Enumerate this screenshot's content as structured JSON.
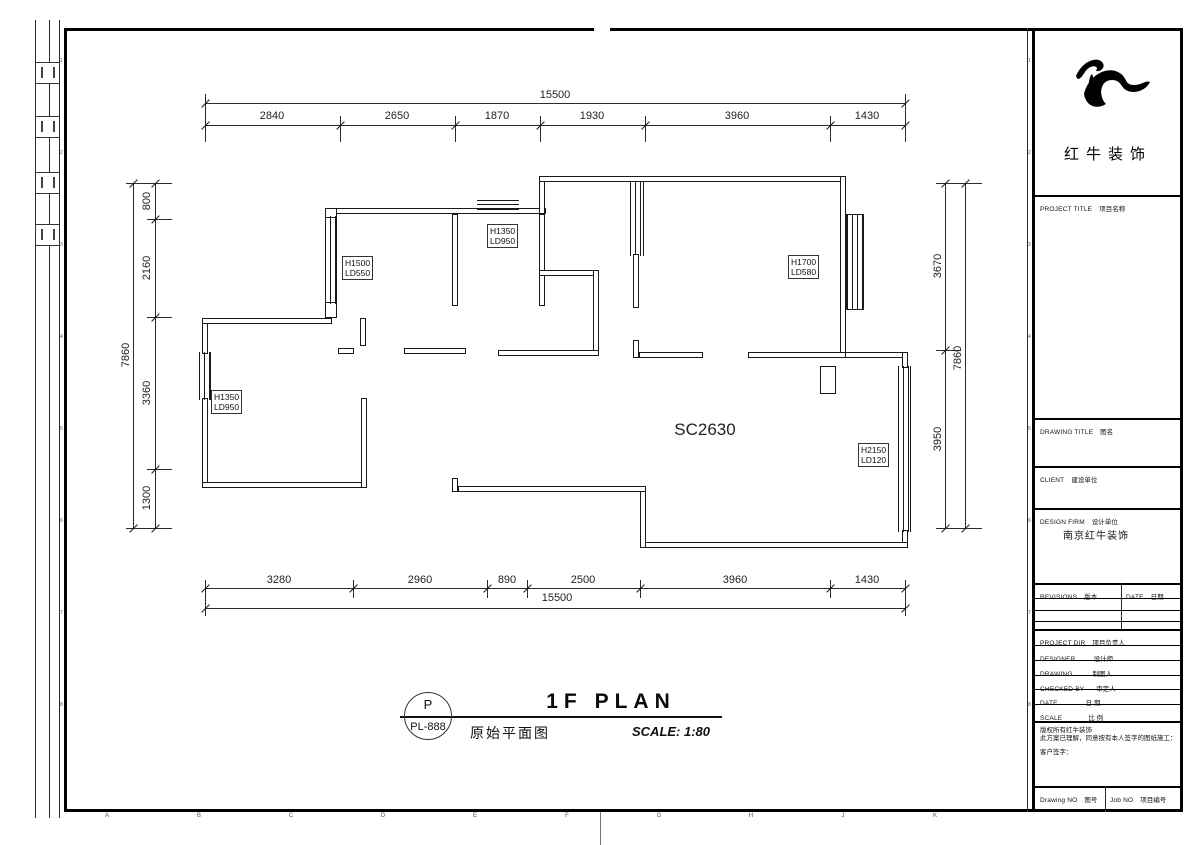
{
  "plan": {
    "room_code": "SC2630",
    "window_labels": [
      {
        "line1": "H1500",
        "line2": "LD550"
      },
      {
        "line1": "H1350",
        "line2": "LD950"
      },
      {
        "line1": "H1700",
        "line2": "LD580"
      },
      {
        "line1": "H1350",
        "line2": "LD950"
      },
      {
        "line1": "H2150",
        "line2": "LD120"
      }
    ]
  },
  "dims": {
    "top_total": "15500",
    "top_segments": [
      "2840",
      "2650",
      "1870",
      "1930",
      "3960",
      "1430"
    ],
    "bottom_segments": [
      "3280",
      "2960",
      "890",
      "2500",
      "3960",
      "1430"
    ],
    "bottom_total": "15500",
    "left_total": "7860",
    "left_segments": [
      "800",
      "2160",
      "3360",
      "1300"
    ],
    "right_segments": [
      "3670",
      "3950"
    ],
    "right_total": "7860"
  },
  "footer": {
    "bubble_letter": "P",
    "bubble_code": "PL-888",
    "title_en": "1F PLAN",
    "title_zh": "原始平面图",
    "scale_text": "SCALE: 1:80"
  },
  "titleblock": {
    "brand_zh": "红牛装饰",
    "project_title_en": "PROJECT TITLE",
    "project_title_zh": "项目名称",
    "drawing_title_en": "DRAWING TITLE",
    "drawing_title_zh": "图名",
    "client_en": "CLIENT",
    "client_zh": "建设单位",
    "design_firm_en": "DESIGN FIRM",
    "design_firm_zh": "设计单位",
    "design_firm_value": "南京红牛装饰",
    "revisions_en": "REVISIONS",
    "revisions_zh": "版本",
    "rev_date_en": "DATE",
    "rev_date_zh": "日期",
    "project_dir_en": "PROJECT DIR",
    "project_dir_zh": "项目负责人",
    "designer_en": "DESIGNER",
    "designer_zh": "设计师",
    "drawing_en": "DRAWING",
    "drawing_zh": "制图人",
    "checked_en": "CHECKED BY",
    "checked_zh": "审定人",
    "date_en": "DATE",
    "date_zh": "日 期",
    "scale_en": "SCALE",
    "scale_zh": "比 例",
    "note_line1": "版权所有红牛装饰",
    "note_line2": "此方案已理解，同意按有本人签字的图纸施工：",
    "note_line3": "客户签字：",
    "drawing_no_en": "Drawing NO",
    "drawing_no_zh": "图号",
    "job_no_en": "Job NO",
    "job_no_zh": "项目编号"
  },
  "grid": {
    "bottom_letters": [
      "A",
      "B",
      "C",
      "D",
      "E",
      "F",
      "G",
      "H",
      "J",
      "K"
    ],
    "right_numbers": [
      "1",
      "2",
      "3",
      "4",
      "5",
      "6",
      "7",
      "8"
    ],
    "left_numbers": [
      "1",
      "2",
      "3",
      "4",
      "5",
      "6",
      "7",
      "8"
    ]
  }
}
